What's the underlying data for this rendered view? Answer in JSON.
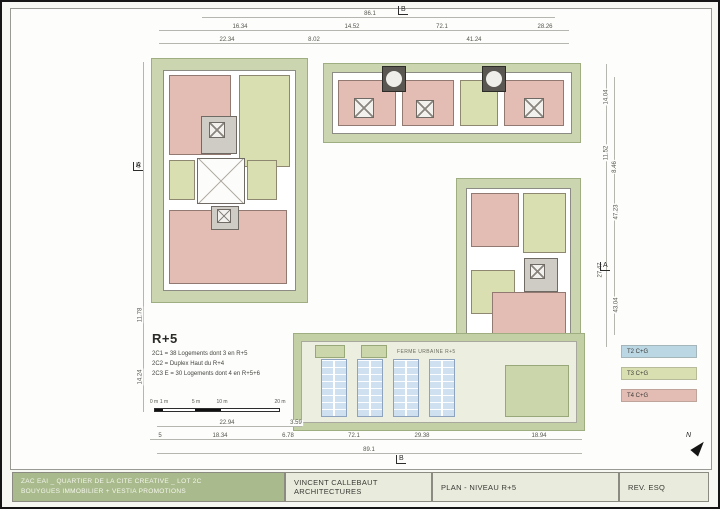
{
  "sheet": {
    "title_block": {
      "project_line1": "ZAC EAI _ QUARTIER DE LA CITE CREATIVE _ LOT 2C",
      "project_line2": "BOUYGUES IMMOBILIER + VESTIA PROMOTIONS",
      "architect": "VINCENT CALLEBAUT ARCHITECTURES",
      "plan_title": "PLAN - NIVEAU R+5",
      "revision": "REV. ESQ"
    },
    "north_label": "N"
  },
  "notes": {
    "heading": "R+5",
    "lines": [
      "2C1 = 38 Logements dont 3 en R+5",
      "2C2 = Duplex Haut du R+4",
      "2C3 E = 30 Logements dont 4 en R+5+6"
    ]
  },
  "legend": {
    "items": [
      {
        "label": "T2 C+G",
        "color": "#bcd7e4"
      },
      {
        "label": "T3 C+G",
        "color": "#dadfb2"
      },
      {
        "label": "T4 C+G",
        "color": "#e3bcb4"
      }
    ]
  },
  "farm": {
    "label": "FERME URBAINE R+5"
  },
  "scalebar": {
    "labels": [
      "0 m",
      "1 m",
      "5 m",
      "10 m",
      "20 m"
    ]
  },
  "section_marks": {
    "top": "B",
    "bottom": "B",
    "left": "A",
    "right": "A"
  },
  "dimensions": {
    "top": [
      "86.1",
      "16.34",
      "14.52",
      "72.1",
      "28.26",
      "22.34",
      "8.02",
      "41.24"
    ],
    "bottom": [
      "22.94",
      "3.59",
      "5",
      "18.34",
      "6.78",
      "72.1",
      "29.38",
      "18.94",
      "89.1"
    ],
    "left": [
      "45",
      "11.78",
      "14.24"
    ],
    "right": [
      "14.04",
      "11.52",
      "8.46",
      "47.23",
      "27.47",
      "43.04"
    ]
  }
}
